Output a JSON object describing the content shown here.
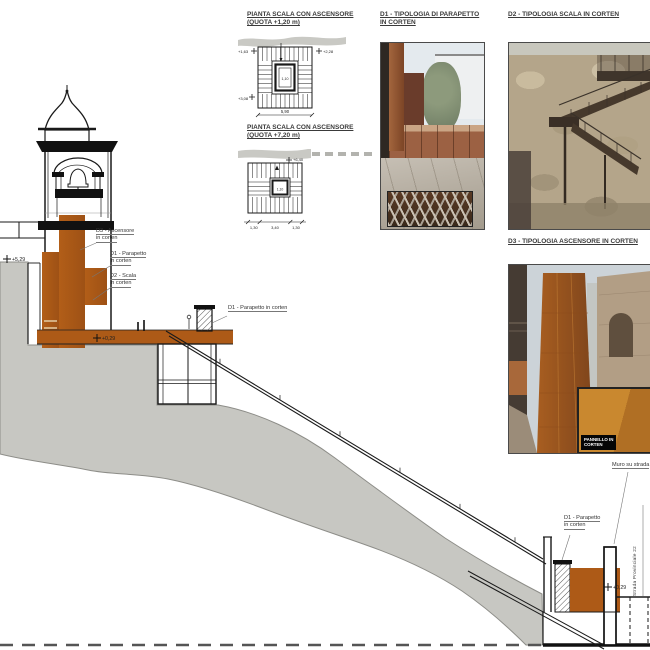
{
  "titles": {
    "plan1_line1": "PIANTA SCALA CON ASCENSORE",
    "plan1_line2": "(QUOTA +1,20 m)",
    "plan2_line1": "PIANTA SCALA CON ASCENSORE",
    "plan2_line2": "(QUOTA +7,20 m)",
    "d1_line1": "D1 - TIPOLOGIA DI PARAPETTO",
    "d1_line2": "IN CORTEN",
    "d2": "D2 - TIPOLOGIA SCALA IN CORTEN",
    "d3": "D3 - TIPOLOGIA ASCENSORE IN CORTEN"
  },
  "plan1": {
    "level_tl": "+1,63",
    "level_tr": "+2,28",
    "level_bl": "+3,08",
    "dim_total": "5,90",
    "dim_shaft": "1,10"
  },
  "plan2": {
    "level_tr": "+6,40",
    "dim_left": "1,30",
    "dim_mid": "3,40",
    "dim_right": "1,30",
    "dim_shaft": "1,10"
  },
  "callouts": {
    "ascensore_l1": "D3 - Ascensore",
    "ascensore_l2": "in corten",
    "parapetto_l1": "D1 - Parapetto",
    "parapetto_l2": "in corten",
    "scala_l1": "D2 - Scala",
    "scala_l2": "in corten",
    "parapetto_mid": "D1 - Parapetto in corten",
    "muro": "Muro su strada",
    "parapetto_low_l1": "D1 - Parapetto",
    "parapetto_low_l2": "in corten",
    "strada": "Strada Provinciale 22"
  },
  "levels": {
    "piazza_upper": "+5,29",
    "deck": "+0,29",
    "street": "+0,29"
  },
  "photo_labels": {
    "d3_inset_l1": "PANNELLO IN",
    "d3_inset_l2": "CORTEN"
  },
  "colors": {
    "corten": "#ad5a17",
    "terrain": "#c7c7c2",
    "line": "#1a1a1a"
  }
}
